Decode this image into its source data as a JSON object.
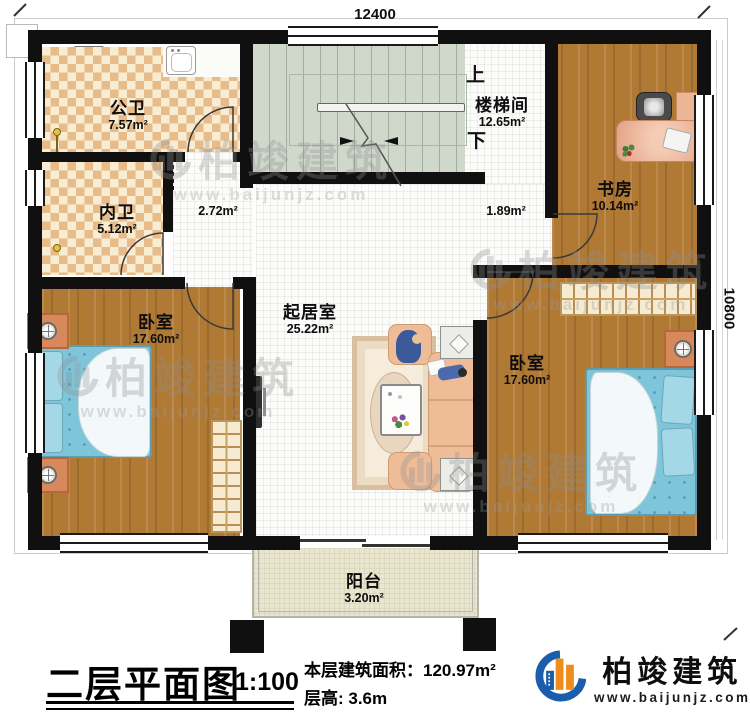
{
  "plan": {
    "dim_top": "12400",
    "dim_right": "10800",
    "up_label": "上",
    "down_label": "下"
  },
  "rooms": {
    "public_bath": {
      "name": "公卫",
      "area": "7.57m²"
    },
    "private_bath": {
      "name": "内卫",
      "area": "5.12m²"
    },
    "stairwell": {
      "name": "楼梯间",
      "area": "12.65m²"
    },
    "study": {
      "name": "书房",
      "area": "10.14m²"
    },
    "bedroom_left": {
      "name": "卧室",
      "area": "17.60m²"
    },
    "bedroom_right": {
      "name": "卧室",
      "area": "17.60m²"
    },
    "living_room": {
      "name": "起居室",
      "area": "25.22m²"
    },
    "balcony": {
      "name": "阳台",
      "area": "3.20m²"
    },
    "hallway": {
      "area": "2.72m²"
    },
    "stair_landing": {
      "area": "1.89m²"
    }
  },
  "title_block": {
    "title": "二层平面图",
    "scale": "1:100",
    "floor_area": "本层建筑面积：120.97m²",
    "floor_height": "层高: 3.6m"
  },
  "brand": {
    "name": "柏竣建筑",
    "website": "www.baijunjz.com"
  },
  "watermark": {
    "name": "柏竣建筑",
    "website": "www.baijunjz.com"
  },
  "colors": {
    "wall": "#101010",
    "wood": "#b07a35",
    "tile_dark": "#e8bc8a",
    "tile_light": "#f8ecd2",
    "stair": "#cfd8cb",
    "bed_blue": "#7fc5da",
    "sofa_peach": "#eebd98",
    "balcony_floor": "#eae6cd",
    "logo_blue": "#1a5dab",
    "logo_orange": "#f08c1e"
  }
}
